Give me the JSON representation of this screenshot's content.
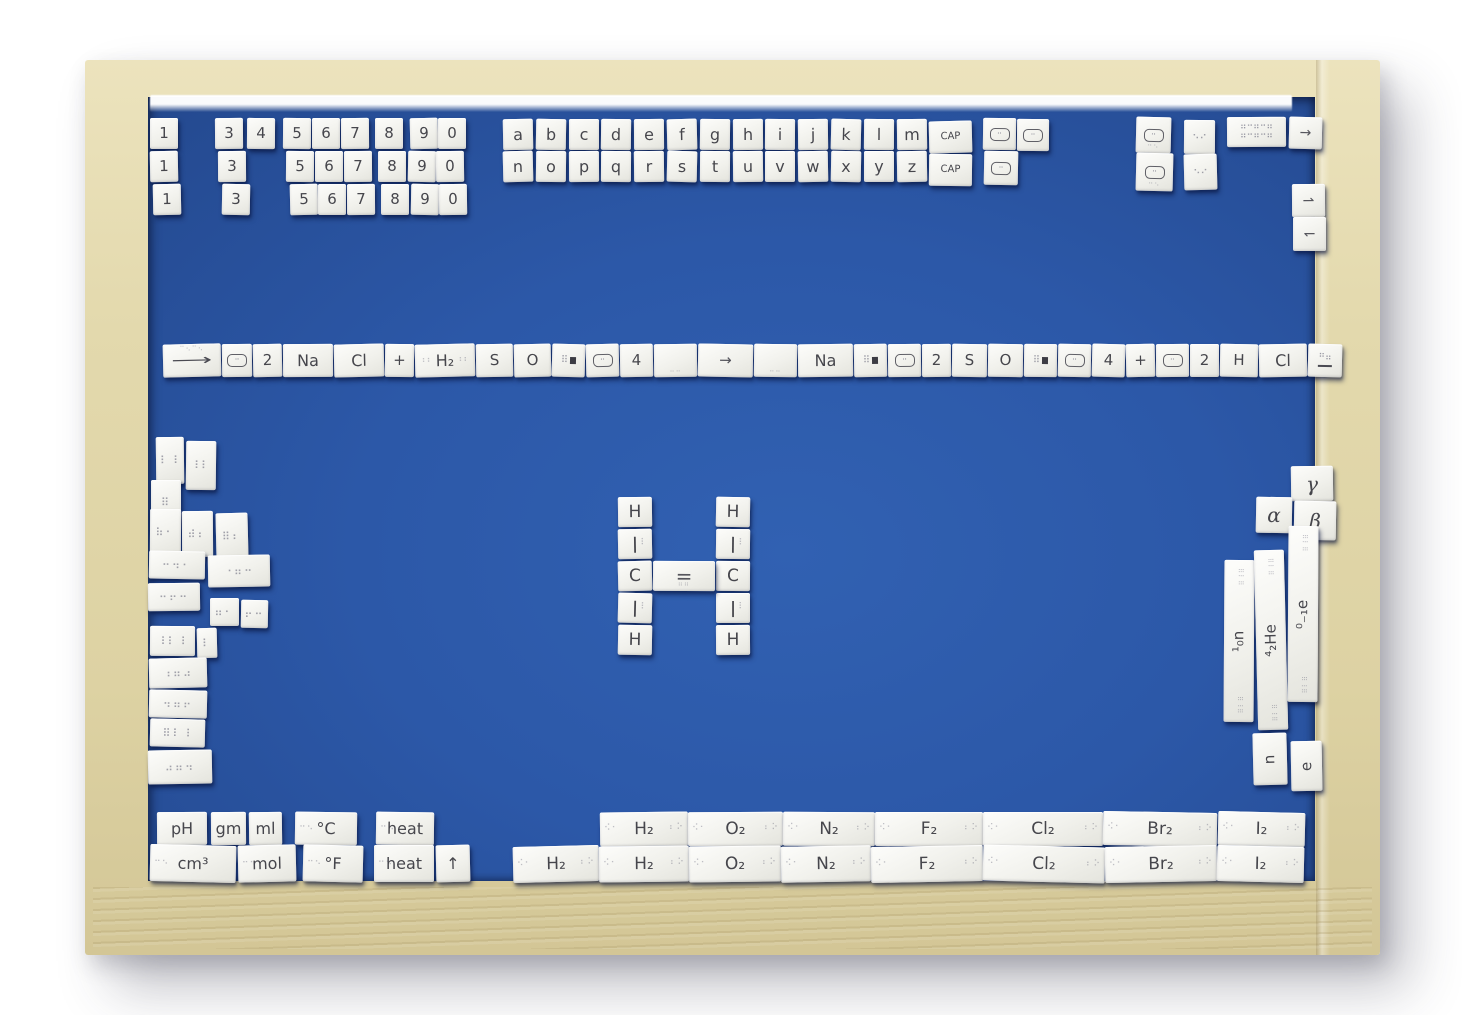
{
  "colors": {
    "surface_blue": "#2b57a7",
    "frame_wood": "#e0d6a8",
    "tile_white": "#f3f3ef"
  },
  "tiles": {
    "numbers": [
      [
        "1",
        "3",
        "4",
        "5",
        "6",
        "7",
        "8",
        "9",
        "0"
      ],
      [
        "1",
        "3",
        "5",
        "6",
        "7",
        "8",
        "9",
        "0"
      ],
      [
        "1",
        "3",
        "5",
        "6",
        "7",
        "8",
        "9",
        "0"
      ]
    ],
    "alphabet": [
      [
        "a",
        "b",
        "c",
        "d",
        "e",
        "f",
        "g",
        "h",
        "i",
        "j",
        "k",
        "l",
        "m"
      ],
      [
        "n",
        "o",
        "p",
        "q",
        "r",
        "s",
        "t",
        "u",
        "v",
        "w",
        "x",
        "y",
        "z"
      ]
    ],
    "cap": [
      "CAP",
      "CAP"
    ],
    "top_symbols": [
      {
        "type": "rrect"
      },
      {
        "type": "rrect"
      },
      {
        "type": "rrect"
      },
      {
        "type": "rrect-dots",
        "glyph": "⠒⠢"
      },
      {
        "type": "rrect-dots",
        "glyph": "⠒⠢"
      },
      {
        "type": "braille",
        "glyph": "⠢⠔"
      },
      {
        "type": "braille",
        "glyph": "⠢⠔"
      },
      {
        "type": "brl2",
        "glyph": "⠶⠒⠶⠒⠶"
      },
      {
        "type": "arrow",
        "label": "→"
      },
      {
        "type": "arrow",
        "label": "⇀"
      },
      {
        "type": "arrow",
        "label": "↽"
      }
    ],
    "equation": [
      {
        "type": "wordarrow",
        "label": "⟶",
        "glyph": "⠉⠢⠉⠢"
      },
      {
        "type": "rrect"
      },
      {
        "type": "text",
        "label": "2"
      },
      {
        "type": "text",
        "label": "Na"
      },
      {
        "type": "text",
        "label": "Cl"
      },
      {
        "type": "text",
        "label": "+"
      },
      {
        "type": "text",
        "label": "H₂",
        "braille": "⠰⠆"
      },
      {
        "type": "text",
        "label": "S"
      },
      {
        "type": "text",
        "label": "O"
      },
      {
        "type": "sq",
        "glyph": "⠿"
      },
      {
        "type": "rrect"
      },
      {
        "type": "text",
        "label": "4"
      },
      {
        "type": "blank",
        "glyph": "⠤⠤"
      },
      {
        "type": "arrow",
        "label": "→"
      },
      {
        "type": "blank",
        "glyph": "⠤⠤"
      },
      {
        "type": "text",
        "label": "Na"
      },
      {
        "type": "sq",
        "glyph": "⠿"
      },
      {
        "type": "rrect"
      },
      {
        "type": "text",
        "label": "2"
      },
      {
        "type": "text",
        "label": "S"
      },
      {
        "type": "text",
        "label": "O"
      },
      {
        "type": "sq",
        "glyph": "⠿"
      },
      {
        "type": "rrect"
      },
      {
        "type": "text",
        "label": "4"
      },
      {
        "type": "text",
        "label": "+"
      },
      {
        "type": "rrect"
      },
      {
        "type": "text",
        "label": "2"
      },
      {
        "type": "text",
        "label": "H"
      },
      {
        "type": "text",
        "label": "Cl"
      },
      {
        "type": "end",
        "glyph": "⠛⠶"
      }
    ],
    "structure": {
      "left_column": [
        "H",
        "|",
        "C",
        "|",
        "H"
      ],
      "right_column": [
        "H",
        "|",
        "C",
        "|",
        "H"
      ],
      "double_bond": "="
    },
    "left_cluster": [
      "⠇⠸",
      "⠸⠇",
      "⠿",
      "⠷⠂",
      "⠾⠆",
      "⠿⠆",
      "⠒⠲⠂",
      "⠐⠶⠒",
      "⠒⠖⠒",
      "⠶⠂",
      "⠖⠒",
      "⠸⠇⠸",
      "⠇",
      "⠰⠶⠴",
      "⠲⠶⠖",
      "⠿⠇⠸",
      "⠴⠶⠲"
    ],
    "right_cluster": {
      "greek": [
        "γ",
        "α",
        "β"
      ],
      "isotopes": [
        "¹₀n",
        "⁴₂He",
        "⁰₋₁e"
      ],
      "particles": [
        "n",
        "e"
      ]
    },
    "bottom_units": [
      [
        "pH",
        "gm",
        "ml",
        "°C",
        "heat"
      ],
      [
        "cm³",
        "mol",
        "°F",
        "heat",
        "↑"
      ]
    ],
    "bottom_molecules": [
      [
        "H₂",
        "O₂",
        "N₂",
        "F₂",
        "Cl₂",
        "Br₂",
        "I₂"
      ],
      [
        "H₂",
        "H₂",
        "O₂",
        "N₂",
        "F₂",
        "Cl₂",
        "Br₂",
        "I₂"
      ]
    ]
  }
}
